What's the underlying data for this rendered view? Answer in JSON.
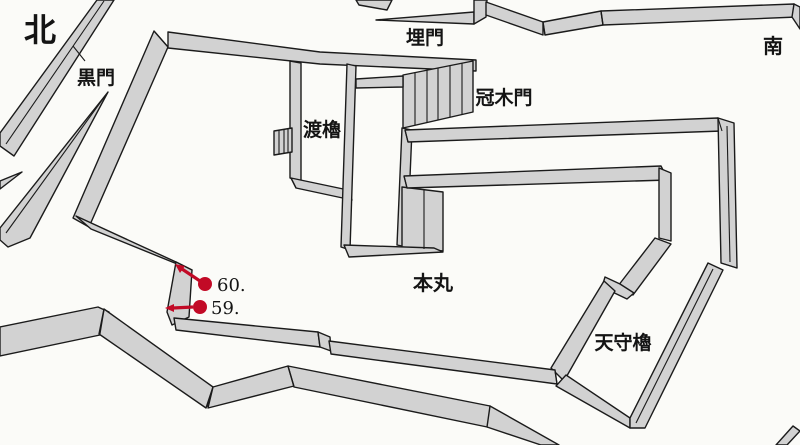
{
  "diagram": {
    "type": "castle-plan-map",
    "colors": {
      "background": "#fbfbf8",
      "wall_fill": "#d2d2d2",
      "wall_stroke": "#1b1b1b",
      "detail_stroke": "#1b1b1b",
      "label_color": "#141414",
      "marker_color": "#c20a26"
    },
    "labels": [
      {
        "id": "north",
        "text": "北",
        "x": 40,
        "y": 41,
        "size": 32
      },
      {
        "id": "kuromon",
        "text": "黒門",
        "x": 96,
        "y": 84,
        "size": 19
      },
      {
        "id": "uzumimon",
        "text": "埋門",
        "x": 425,
        "y": 44,
        "size": 19
      },
      {
        "id": "minami",
        "text": "南",
        "x": 773,
        "y": 53,
        "size": 20
      },
      {
        "id": "watariyagura",
        "text": "渡櫓",
        "x": 322,
        "y": 136,
        "size": 19
      },
      {
        "id": "kabukimon",
        "text": "冠木門",
        "x": 504,
        "y": 104,
        "size": 19
      },
      {
        "id": "honmaru",
        "text": "本丸",
        "x": 433,
        "y": 290,
        "size": 20
      },
      {
        "id": "tenshuyagura",
        "text": "天守櫓",
        "x": 623,
        "y": 349,
        "size": 19
      }
    ],
    "markers": [
      {
        "id": "60",
        "label": "60.",
        "dot": {
          "x": 205,
          "y": 284,
          "r": 7
        },
        "line": {
          "x1": 200,
          "y1": 281,
          "x2": 182,
          "y2": 269
        },
        "head": "175,264 180,273 185,266",
        "text": {
          "x": 217,
          "y": 291,
          "size": 18
        }
      },
      {
        "id": "59",
        "label": "59.",
        "dot": {
          "x": 200,
          "y": 307,
          "r": 7
        },
        "line": {
          "x1": 193,
          "y1": 307,
          "x2": 173,
          "y2": 308
        },
        "head": "165,308 174,304 174,312",
        "text": {
          "x": 211,
          "y": 314,
          "size": 18
        }
      }
    ],
    "walls": [
      {
        "name": "nw-outer-wall",
        "points": "97,0 114,0 14,156 0,146 0,133"
      },
      {
        "name": "kuromon-spike-wall",
        "points": "108,92 30,238 8,247 0,240 0,228"
      },
      {
        "name": "west-sliver-wall",
        "points": "22,172 0,181 0,189"
      },
      {
        "name": "honmaru-west-wall",
        "points": "154,31 168,47 89,227 73,218"
      },
      {
        "name": "honmaru-north-wall",
        "points": "168,32 320,52 476,60 476,71 320,64 168,48"
      },
      {
        "name": "kabukimon-gate",
        "points": "403,75 473,61 473,112 403,128"
      },
      {
        "name": "watariyagura-west-wall",
        "points": "290,61 301,63 301,182 290,178"
      },
      {
        "name": "watariyagura-south-wall",
        "points": "291,178 348,190 352,200 296,188"
      },
      {
        "name": "west-stairs",
        "points": "274,131 292,128 292,152 274,155"
      },
      {
        "name": "corridor-west-wall",
        "points": "347,64 356,66 350,250 341,247"
      },
      {
        "name": "corridor-bridge",
        "points": "356,79 403,76 403,87 356,88"
      },
      {
        "name": "corridor-east-wall",
        "points": "402,128 412,130 407,247 397,245"
      },
      {
        "name": "south-gate-steps",
        "points": "402,187 443,192 443,251 402,247"
      },
      {
        "name": "corridor-south-wall",
        "points": "344,245 434,248 443,252 349,257"
      },
      {
        "name": "northeast-wall-upper",
        "points": "405,130 718,118 722,131 408,142"
      },
      {
        "name": "east-wall-north",
        "points": "718,118 734,123 737,268 721,263"
      },
      {
        "name": "northeast-wall-lower",
        "points": "404,176 661,166 668,180 407,188"
      },
      {
        "name": "east-wall-inner-vertical",
        "points": "659,168 671,173 671,241 659,238"
      },
      {
        "name": "tenshu-northwest-wall",
        "points": "655,238 671,244 633,295 618,286"
      },
      {
        "name": "tenshu-west-step",
        "points": "605,277 620,284 634,293 627,299 602,287"
      },
      {
        "name": "tenshu-west-wall",
        "points": "604,281 615,291 564,381 551,368"
      },
      {
        "name": "tenshu-south-wall",
        "points": "566,375 630,418 630,428 556,386"
      },
      {
        "name": "tenshu-east-wall",
        "points": "630,418 708,263 723,270 645,428 630,428"
      },
      {
        "name": "south-rim-sliver",
        "points": "376,20 474,12 474,24"
      },
      {
        "name": "south-rim-cap",
        "points": "474,0 487,0 486,17 474,24"
      },
      {
        "name": "south-rim-west",
        "points": "486,2 543,22 543,35 486,15"
      },
      {
        "name": "south-rim-mid",
        "points": "543,22 601,11 603,25 545,35"
      },
      {
        "name": "south-rim-long",
        "points": "601,11 794,4 797,17 603,25"
      },
      {
        "name": "south-rim-end-cap",
        "points": "794,4 800,7 800,29 792,17"
      },
      {
        "name": "north-gap-fragment",
        "points": "356,0 392,0 387,10 359,5"
      },
      {
        "name": "notch-upper-wall",
        "points": "76,216 91,229 192,270 176,262"
      },
      {
        "name": "marker-notch-wall",
        "points": "176,262 192,270 189,317 172,325 167,312"
      },
      {
        "name": "inner-south-wall-west",
        "points": "174,318 318,332 320,347 176,330"
      },
      {
        "name": "inner-south-wall-step",
        "points": "318,332 330,337 331,351 320,347"
      },
      {
        "name": "inner-south-wall-east",
        "points": "329,341 555,370 557,384 331,354"
      },
      {
        "name": "outer-wall-west",
        "points": "0,327 98,307 109,312 100,335 0,356"
      },
      {
        "name": "outer-wall-descent",
        "points": "104,309 213,387 206,408 99,334"
      },
      {
        "name": "outer-wall-rise",
        "points": "213,387 288,366 294,386 208,408"
      },
      {
        "name": "outer-wall-east",
        "points": "288,366 490,406 492,428 294,387"
      },
      {
        "name": "outer-wall-south-exit",
        "points": "490,406 559,445 541,445 487,427"
      },
      {
        "name": "bottom-right-fragment",
        "points": "776,445 793,426 800,431 787,445"
      }
    ],
    "detail_lines": [
      {
        "name": "nw-wall-ridge",
        "x1": 104,
        "y1": 1,
        "x2": 6,
        "y2": 144
      },
      {
        "name": "nw-wall-joint",
        "x1": 73,
        "y1": 46,
        "x2": 85,
        "y2": 61
      },
      {
        "name": "spike-ridge",
        "x1": 105,
        "y1": 96,
        "x2": 6,
        "y2": 233
      },
      {
        "name": "west-corner-edge",
        "x1": 154,
        "y1": 31,
        "x2": 168,
        "y2": 47
      },
      {
        "name": "rim-joint-west",
        "x1": 543,
        "y1": 22,
        "x2": 545,
        "y2": 35
      },
      {
        "name": "rim-joint-mid",
        "x1": 601,
        "y1": 11,
        "x2": 603,
        "y2": 25
      },
      {
        "name": "upper-wall-cap",
        "x1": 405,
        "y1": 130,
        "x2": 408,
        "y2": 142
      },
      {
        "name": "lower-wall-cap",
        "x1": 404,
        "y1": 176,
        "x2": 407,
        "y2": 188
      },
      {
        "name": "east-corner-edge",
        "x1": 718,
        "y1": 118,
        "x2": 722,
        "y2": 131
      },
      {
        "name": "east-wall-ridge",
        "x1": 727,
        "y1": 126,
        "x2": 730,
        "y2": 262
      },
      {
        "name": "east-wall-joint",
        "x1": 721,
        "y1": 263,
        "x2": 737,
        "y2": 268
      },
      {
        "name": "tenshu-east-ridge",
        "x1": 713,
        "y1": 269,
        "x2": 636,
        "y2": 423
      },
      {
        "name": "tenshu-west-corner",
        "x1": 555,
        "y1": 371,
        "x2": 557,
        "y2": 384
      },
      {
        "name": "zigzag-peak-ridge",
        "x1": 104,
        "y1": 310,
        "x2": 100,
        "y2": 334
      },
      {
        "name": "zigzag-valley-ridge",
        "x1": 213,
        "y1": 387,
        "x2": 207,
        "y2": 407
      },
      {
        "name": "zigzag-joint",
        "x1": 288,
        "y1": 366,
        "x2": 294,
        "y2": 386
      },
      {
        "name": "box-corner-edge",
        "x1": 291,
        "y1": 178,
        "x2": 296,
        "y2": 188
      }
    ],
    "gate_bars": [
      {
        "name": "kabukimon-bar",
        "x1": 415,
        "y1": 73,
        "x2": 415,
        "y2": 125
      },
      {
        "name": "kabukimon-bar",
        "x1": 427,
        "y1": 70,
        "x2": 427,
        "y2": 123
      },
      {
        "name": "kabukimon-bar",
        "x1": 438,
        "y1": 68,
        "x2": 438,
        "y2": 120
      },
      {
        "name": "kabukimon-bar",
        "x1": 450,
        "y1": 66,
        "x2": 450,
        "y2": 117
      },
      {
        "name": "kabukimon-bar",
        "x1": 462,
        "y1": 63,
        "x2": 462,
        "y2": 115
      },
      {
        "name": "south-gate-bar",
        "x1": 424,
        "y1": 190,
        "x2": 424,
        "y2": 249
      },
      {
        "name": "west-stairs-bar",
        "x1": 279,
        "y1": 130,
        "x2": 279,
        "y2": 154
      },
      {
        "name": "west-stairs-bar",
        "x1": 284,
        "y1": 129,
        "x2": 284,
        "y2": 154
      },
      {
        "name": "west-stairs-bar",
        "x1": 288,
        "y1": 129,
        "x2": 288,
        "y2": 153
      }
    ]
  }
}
